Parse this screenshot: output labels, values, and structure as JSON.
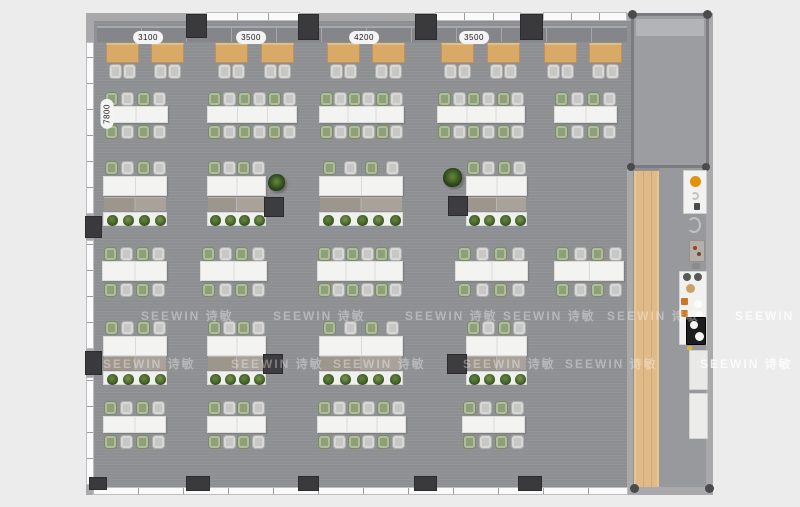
{
  "scene": {
    "type": "office-floor-plan-top-view"
  },
  "watermark_text": "SEEWIN 诗敏",
  "dimension_labels": {
    "top": [
      {
        "text": "3100",
        "cx": 148,
        "y": 31
      },
      {
        "text": "3500",
        "cx": 251,
        "y": 31
      },
      {
        "text": "4200",
        "cx": 364,
        "y": 31
      },
      {
        "text": "3500",
        "cx": 474,
        "y": 31
      }
    ],
    "left": [
      {
        "text": "7800",
        "cx": 107,
        "cy": 114
      }
    ]
  },
  "palette": {
    "outside_bg": "#ececec",
    "floor": "#909194",
    "corridor_floor": "#98999c",
    "room_floor": "#9c9da0",
    "wall": "#a9a9ab",
    "window": "#fafafa",
    "column": "#3a3a3c",
    "bench": "#85868a",
    "wood_table": "#d9a968",
    "wood_strip": "#dcb077",
    "desk": "#f3f3f1",
    "chair_gray": "#c7c8c6",
    "chair_green": "#8fa077",
    "storage": "#a19b92",
    "planter": "#f0f0ee",
    "plant_dark": "#33511f",
    "plant_mid": "#5e7d3b",
    "cabinet_dark": "#3d3d3f",
    "counter_white": "#f2f2f0",
    "accent_orange": "#e2920c",
    "fridge_black": "#1d1d1f"
  },
  "structure": {
    "floor": {
      "x": 93,
      "y": 15,
      "w": 620,
      "h": 477
    },
    "corridor": {
      "x": 659,
      "y": 168,
      "w": 47,
      "h": 319
    },
    "walls": [
      {
        "name": "top-wall",
        "x": 86,
        "y": 13,
        "w": 627,
        "h": 8
      },
      {
        "name": "left-wall",
        "x": 86,
        "y": 13,
        "w": 8,
        "h": 482
      },
      {
        "name": "bottom-wall",
        "x": 86,
        "y": 487,
        "w": 627,
        "h": 8
      },
      {
        "name": "right-wall",
        "x": 706,
        "y": 13,
        "w": 7,
        "h": 482
      },
      {
        "name": "mid-right-wall",
        "x": 627,
        "y": 166,
        "w": 6,
        "h": 326
      }
    ],
    "windows": [
      {
        "name": "window-top-1",
        "x": 206,
        "y": 12,
        "w": 94,
        "h": 9,
        "o": "h",
        "seg": 31
      },
      {
        "name": "window-top-2",
        "x": 435,
        "y": 12,
        "w": 86,
        "h": 9,
        "o": "h",
        "seg": 29
      },
      {
        "name": "window-top-3",
        "x": 543,
        "y": 12,
        "w": 84,
        "h": 9,
        "o": "h",
        "seg": 28
      },
      {
        "name": "window-bottom",
        "x": 93,
        "y": 487,
        "w": 535,
        "h": 8,
        "o": "h",
        "seg": 45
      },
      {
        "name": "window-left-1",
        "x": 86,
        "y": 42,
        "w": 8,
        "h": 172,
        "o": "v",
        "seg": 26
      },
      {
        "name": "window-left-2",
        "x": 86,
        "y": 240,
        "w": 8,
        "h": 109,
        "o": "v",
        "seg": 26
      },
      {
        "name": "window-left-3",
        "x": 86,
        "y": 377,
        "w": 8,
        "h": 108,
        "o": "v",
        "seg": 26
      }
    ],
    "columns": [
      {
        "x": 186,
        "y": 14,
        "w": 21,
        "h": 24
      },
      {
        "x": 298,
        "y": 14,
        "w": 21,
        "h": 26
      },
      {
        "x": 415,
        "y": 14,
        "w": 22,
        "h": 26
      },
      {
        "x": 520,
        "y": 14,
        "w": 23,
        "h": 26
      },
      {
        "x": 89,
        "y": 477,
        "w": 18,
        "h": 13
      },
      {
        "x": 186,
        "y": 476,
        "w": 24,
        "h": 15
      },
      {
        "x": 298,
        "y": 476,
        "w": 21,
        "h": 15
      },
      {
        "x": 414,
        "y": 476,
        "w": 23,
        "h": 15
      },
      {
        "x": 518,
        "y": 476,
        "w": 24,
        "h": 15
      },
      {
        "x": 85,
        "y": 216,
        "w": 17,
        "h": 22
      },
      {
        "x": 85,
        "y": 351,
        "w": 17,
        "h": 24
      }
    ],
    "corner_dots": [
      {
        "x": 628,
        "y": 10,
        "s": 9
      },
      {
        "x": 703,
        "y": 10,
        "s": 9
      },
      {
        "x": 627,
        "y": 163,
        "s": 8
      },
      {
        "x": 702,
        "y": 163,
        "s": 8
      },
      {
        "x": 630,
        "y": 484,
        "s": 9
      },
      {
        "x": 705,
        "y": 484,
        "s": 9
      }
    ],
    "right_room": {
      "x": 631,
      "y": 13,
      "w": 78,
      "h": 155,
      "band": {
        "x": 636,
        "y": 19,
        "w": 68,
        "h": 17
      }
    },
    "bench": {
      "x": 97,
      "y": 26,
      "w": 530,
      "h": 16
    },
    "wood_strip": {
      "x": 634,
      "y": 171,
      "w": 25,
      "h": 316
    }
  },
  "furniture": {
    "cafe_tables": {
      "y": 43,
      "w": 33,
      "h": 20,
      "chair_y": 64,
      "xs": [
        106,
        151,
        215,
        261,
        327,
        372,
        441,
        487,
        544,
        589
      ]
    },
    "desk_rows": [
      {
        "chair_top_y": 92,
        "desk_y": 106,
        "desk_h": 17,
        "chair_bot_y": 125,
        "clusters": [
          {
            "x": 103,
            "w": 65,
            "seats": 4
          },
          {
            "x": 207,
            "w": 90,
            "seats": 6
          },
          {
            "x": 319,
            "w": 85,
            "seats": 6
          },
          {
            "x": 437,
            "w": 88,
            "seats": 6
          },
          {
            "x": 554,
            "w": 63,
            "seats": 4
          }
        ]
      },
      {
        "chair_top_y": 247,
        "desk_y": 261,
        "desk_h": 20,
        "chair_bot_y": 283,
        "clusters": [
          {
            "x": 102,
            "w": 65,
            "seats": 4
          },
          {
            "x": 200,
            "w": 67,
            "seats": 4
          },
          {
            "x": 317,
            "w": 86,
            "seats": 6
          },
          {
            "x": 455,
            "w": 73,
            "seats": 4
          },
          {
            "x": 554,
            "w": 70,
            "seats": 4
          }
        ]
      },
      {
        "chair_top_y": 401,
        "desk_y": 416,
        "desk_h": 17,
        "chair_bot_y": 435,
        "clusters": [
          {
            "x": 103,
            "w": 63,
            "seats": 4
          },
          {
            "x": 207,
            "w": 59,
            "seats": 4
          },
          {
            "x": 317,
            "w": 89,
            "seats": 6
          },
          {
            "x": 462,
            "w": 63,
            "seats": 4
          }
        ]
      }
    ],
    "planter_rows": [
      {
        "chair_y": 161,
        "desk_y": 176,
        "desk_h": 20,
        "storage_y": 197,
        "planter_y": 212,
        "clusters": [
          {
            "x": 103,
            "w": 64
          },
          {
            "x": 207,
            "w": 59
          },
          {
            "x": 319,
            "w": 84
          },
          {
            "x": 466,
            "w": 61
          }
        ]
      },
      {
        "chair_y": 321,
        "desk_y": 336,
        "desk_h": 20,
        "storage_y": 356,
        "planter_y": 371,
        "clusters": [
          {
            "x": 103,
            "w": 64
          },
          {
            "x": 207,
            "w": 59
          },
          {
            "x": 319,
            "w": 84
          },
          {
            "x": 466,
            "w": 61
          }
        ]
      }
    ],
    "dark_cabinets": [
      {
        "x": 264,
        "y": 197,
        "s": 20
      },
      {
        "x": 448,
        "y": 196,
        "s": 20
      },
      {
        "x": 263,
        "y": 354,
        "s": 20
      },
      {
        "x": 447,
        "y": 354,
        "s": 20
      }
    ],
    "free_plants": [
      {
        "x": 268,
        "y": 174,
        "s": 17
      },
      {
        "x": 443,
        "y": 168,
        "s": 19
      }
    ],
    "pantry_fixtures": [
      {
        "name": "pantry-counter",
        "shape": "rect",
        "x": 683,
        "y": 170,
        "w": 24,
        "h": 44,
        "bg": "#f2f2f0",
        "bc": "#cfcfcd"
      },
      {
        "name": "stove-burner",
        "shape": "disc",
        "x": 690,
        "y": 176,
        "w": 11,
        "h": 11,
        "bg": "#e2920c",
        "bc": "#8a5a06"
      },
      {
        "name": "sink-ring",
        "shape": "ring",
        "x": 691,
        "y": 192,
        "w": 8,
        "h": 8
      },
      {
        "name": "tap-glyph",
        "shape": "rect",
        "x": 694,
        "y": 203,
        "w": 6,
        "h": 7,
        "bg": "#4a4a4c"
      },
      {
        "name": "stool-ring",
        "shape": "ring",
        "x": 687,
        "y": 217,
        "w": 14,
        "h": 16
      },
      {
        "name": "coffee-machine",
        "shape": "rect",
        "x": 689,
        "y": 240,
        "w": 16,
        "h": 22,
        "bg": "#b5b0a8",
        "bc": "#96918a"
      },
      {
        "name": "coffee-dot-1",
        "shape": "disc",
        "x": 693,
        "y": 246,
        "w": 4,
        "h": 4,
        "bg": "#a23b2a"
      },
      {
        "name": "coffee-dot-2",
        "shape": "disc",
        "x": 697,
        "y": 252,
        "w": 4,
        "h": 4,
        "bg": "#6b4a2e"
      },
      {
        "name": "small-item",
        "shape": "rect",
        "x": 692,
        "y": 263,
        "w": 8,
        "h": 6,
        "bg": "#8c8c8e"
      },
      {
        "name": "pantry-counter-2",
        "shape": "rect",
        "x": 679,
        "y": 271,
        "w": 28,
        "h": 74,
        "bg": "#f1f1ef",
        "bc": "#d4d4d2"
      },
      {
        "name": "vent-glyph-1",
        "shape": "disc",
        "x": 683,
        "y": 273,
        "w": 8,
        "h": 8,
        "bg": "#5a5a55"
      },
      {
        "name": "vent-glyph-2",
        "shape": "disc",
        "x": 694,
        "y": 273,
        "w": 8,
        "h": 8,
        "bg": "#5a5a55"
      },
      {
        "name": "wood-bowl",
        "shape": "disc",
        "x": 686,
        "y": 284,
        "w": 9,
        "h": 9,
        "bg": "#c9a264"
      },
      {
        "name": "hob-orange-1",
        "shape": "rect",
        "x": 681,
        "y": 298,
        "w": 7,
        "h": 7,
        "bg": "#c7792a"
      },
      {
        "name": "plate-1",
        "shape": "disc",
        "x": 694,
        "y": 300,
        "w": 8,
        "h": 8,
        "bg": "#fbfbf9",
        "bc": "#cccccc"
      },
      {
        "name": "hob-orange-2",
        "shape": "rect",
        "x": 681,
        "y": 310,
        "w": 7,
        "h": 7,
        "bg": "#c7792a"
      },
      {
        "name": "plate-2",
        "shape": "disc",
        "x": 696,
        "y": 311,
        "w": 7,
        "h": 7,
        "bg": "#fbfbf9",
        "bc": "#cccccc"
      },
      {
        "name": "fridge",
        "shape": "rect",
        "x": 686,
        "y": 317,
        "w": 20,
        "h": 28,
        "bg": "#1d1d1f",
        "bc": "#000000"
      },
      {
        "name": "fridge-plate-1",
        "shape": "disc",
        "x": 690,
        "y": 321,
        "w": 8,
        "h": 8,
        "bg": "#f5f5f3"
      },
      {
        "name": "fridge-plate-2",
        "shape": "disc",
        "x": 695,
        "y": 332,
        "w": 9,
        "h": 9,
        "bg": "#f5f5f3"
      },
      {
        "name": "warning-tick",
        "shape": "rect",
        "x": 687,
        "y": 346,
        "w": 5,
        "h": 4,
        "bg": "#d8b43c"
      },
      {
        "name": "tall-cabinet-1",
        "shape": "rect",
        "x": 689,
        "y": 350,
        "w": 19,
        "h": 40,
        "bg": "#e9e9e7",
        "bc": "#d0d0ce"
      },
      {
        "name": "tall-cabinet-2",
        "shape": "rect",
        "x": 689,
        "y": 393,
        "w": 19,
        "h": 46,
        "bg": "#ececea",
        "bc": "#d2d2d0"
      }
    ]
  },
  "watermarks": [
    {
      "x": 141,
      "y": 307
    },
    {
      "x": 273,
      "y": 307
    },
    {
      "x": 405,
      "y": 307
    },
    {
      "x": 503,
      "y": 307
    },
    {
      "x": 607,
      "y": 307
    },
    {
      "x": 735,
      "y": 307,
      "outside": true
    },
    {
      "x": 103,
      "y": 355
    },
    {
      "x": 231,
      "y": 355
    },
    {
      "x": 333,
      "y": 355
    },
    {
      "x": 463,
      "y": 355
    },
    {
      "x": 565,
      "y": 355
    },
    {
      "x": 700,
      "y": 355,
      "outside": true
    }
  ]
}
